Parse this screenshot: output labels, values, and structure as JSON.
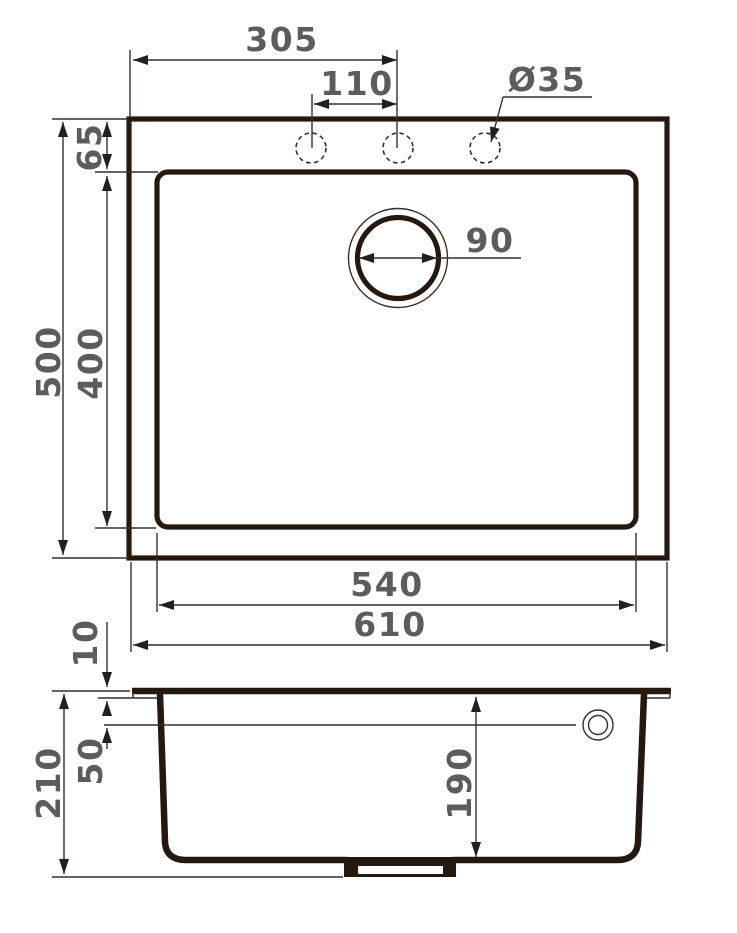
{
  "drawing": {
    "type": "sink-dimension-drawing",
    "colors": {
      "background": "#ffffff",
      "outline": "#25190f",
      "dim_lines": "#35302a",
      "dim_text": "#5c5c5c"
    },
    "top_view": {
      "overall_width": "610",
      "inner_bowl_width": "540",
      "overall_depth": "500",
      "inner_bowl_depth": "400",
      "rim_to_bowl": "65",
      "tap_hole_offset": "305",
      "tap_hole_spacing": "110",
      "tap_hole_diameter": "Ø35",
      "drain_diameter": "90"
    },
    "section_view": {
      "overall_height": "210",
      "bowl_inner_depth": "190",
      "rim_thickness": "10",
      "overflow_offset": "50"
    }
  }
}
